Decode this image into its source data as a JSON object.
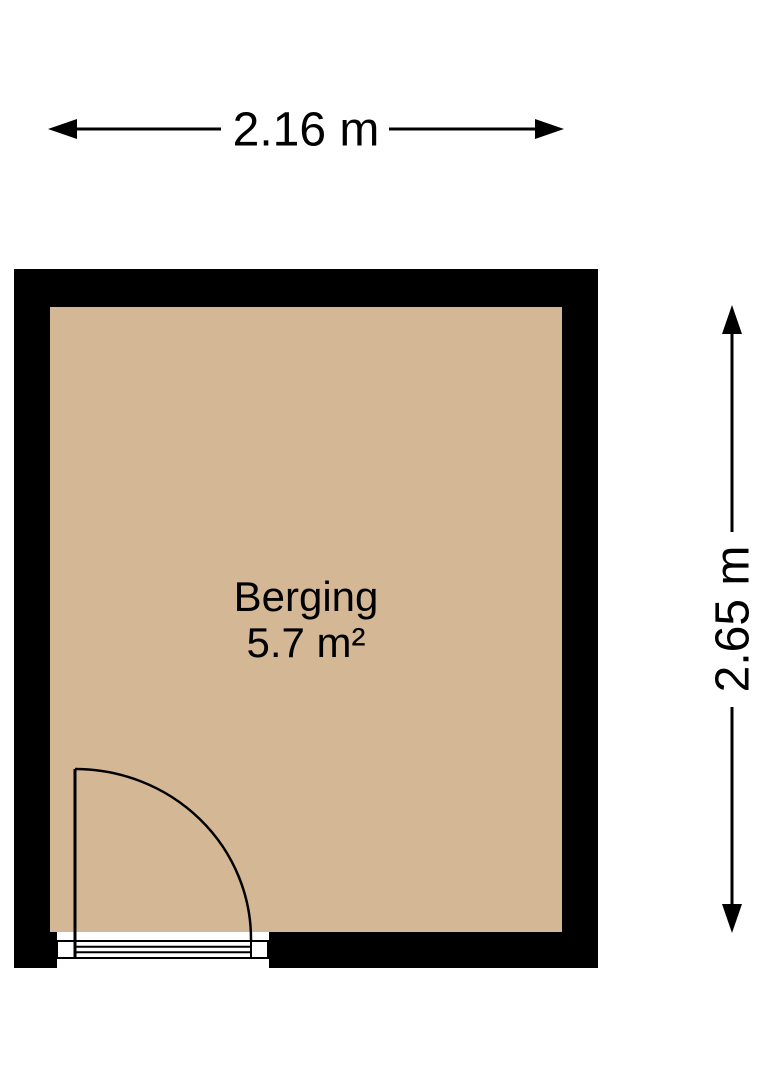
{
  "floorplan": {
    "room": {
      "name": "Berging",
      "area_label": "5.7 m²"
    },
    "dimensions": {
      "width_label": "2.16 m",
      "height_label": "2.65 m"
    },
    "colors": {
      "wall": "#000000",
      "floor": "#d4b896",
      "line": "#000000",
      "background": "#ffffff",
      "text": "#000000"
    }
  }
}
